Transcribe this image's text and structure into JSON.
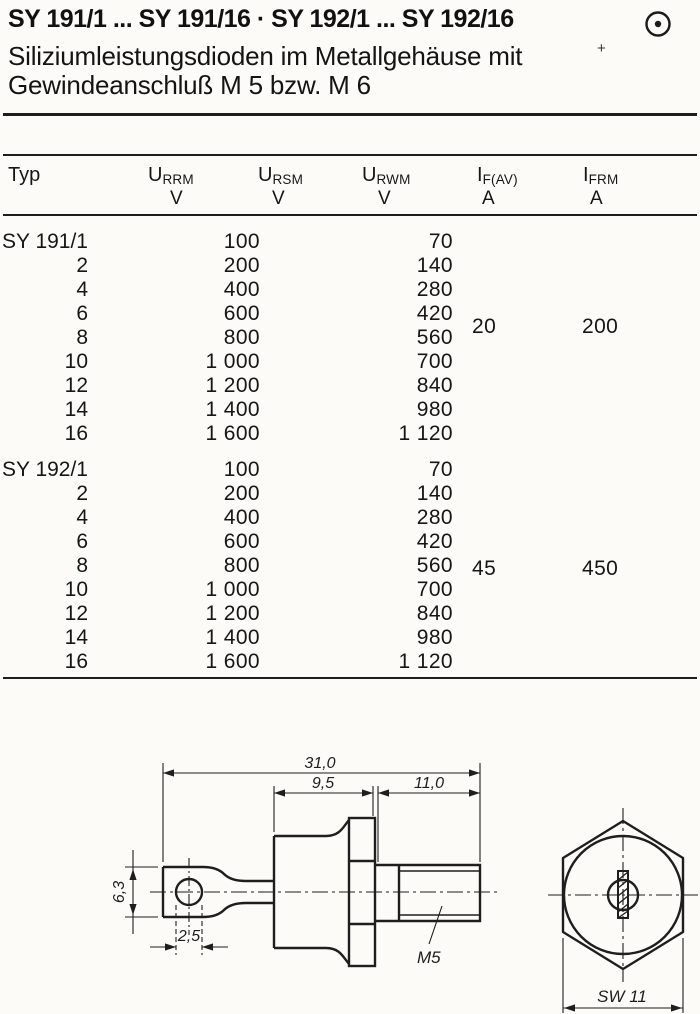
{
  "page": {
    "title": "SY 191/1 ... SY 191/16 · SY 192/1 ... SY 192/16",
    "subtitle_line1": "Siliziumleistungsdioden im Metallgehäuse mit",
    "subtitle_line2": "Gewindeanschluß M 5 bzw. M 6",
    "logo_icon": "circled-dot",
    "registration_mark": "+",
    "ink_color": "#1b1b1b",
    "paper_color": "#fcfbf7"
  },
  "table": {
    "header": {
      "typ": "Typ",
      "columns": [
        {
          "symbol": "U",
          "sub": "RRM",
          "unit": "V"
        },
        {
          "symbol": "U",
          "sub": "RSM",
          "unit": "V"
        },
        {
          "symbol": "U",
          "sub": "RWM",
          "unit": "V"
        },
        {
          "symbol": "I",
          "sub": "F(AV)",
          "unit": "A"
        },
        {
          "symbol": "I",
          "sub": "FRM",
          "unit": "A"
        }
      ]
    },
    "blocks": [
      {
        "name": "sy191",
        "rows": [
          [
            "SY 191/1",
            "100",
            "70"
          ],
          [
            "2",
            "200",
            "140"
          ],
          [
            "4",
            "400",
            "280"
          ],
          [
            "6",
            "600",
            "420"
          ],
          [
            "8",
            "800",
            "560"
          ],
          [
            "10",
            "1 000",
            "700"
          ],
          [
            "12",
            "1 200",
            "840"
          ],
          [
            "14",
            "1 400",
            "980"
          ],
          [
            "16",
            "1 600",
            "1 120"
          ]
        ],
        "if_av": "20",
        "ifrm": "200"
      },
      {
        "name": "sy192",
        "rows": [
          [
            "SY 192/1",
            "100",
            "70"
          ],
          [
            "2",
            "200",
            "140"
          ],
          [
            "4",
            "400",
            "280"
          ],
          [
            "6",
            "600",
            "420"
          ],
          [
            "8",
            "800",
            "560"
          ],
          [
            "10",
            "1 000",
            "700"
          ],
          [
            "12",
            "1 200",
            "840"
          ],
          [
            "14",
            "1 400",
            "980"
          ],
          [
            "16",
            "1 600",
            "1 120"
          ]
        ],
        "if_av": "45",
        "ifrm": "450"
      }
    ]
  },
  "drawing": {
    "dim_total": "31,0",
    "dim_body": "9,5",
    "dim_stud": "11,0",
    "dim_tab_height": "6,3",
    "dim_hole": "2,5",
    "thread_label": "M5",
    "wrench_label": "SW 11"
  }
}
